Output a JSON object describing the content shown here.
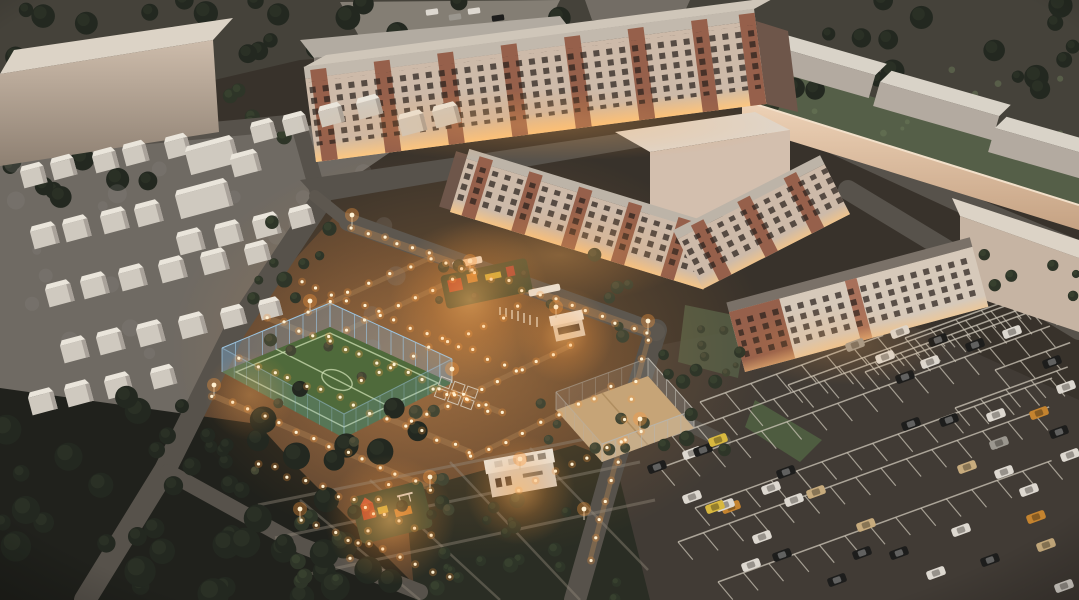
{
  "meta": {
    "type": "aerial-architectural-rendering",
    "time_of_day": "dusk"
  },
  "palette": {
    "night_ground": "#38322b",
    "top_ground": "#4a473f",
    "road": "#57524b",
    "road_edge": "#736c63",
    "asphalt_parking": "#413b35",
    "parking_line": "#cfc8ba",
    "beige_face": "#c8b6a5",
    "beige_roof": "#dcd3c6",
    "beige_shadow": "#8e7f72",
    "wall_warm": "#e2c3a8",
    "brick": "#96604b",
    "facade_base": "#cdbaa9",
    "window_dark": "#2f2722",
    "window_lit": "#ffd9a2",
    "gray_face": "#857e76",
    "gray_roof": "#b2aba1",
    "field_green": "#4f6a3b",
    "field_line": "#cfe0b4",
    "fence_blue": "#7fb2d8",
    "sand_court": "#c6a477",
    "lawn": "#555f48",
    "tree_dark": "#232820",
    "tree_dark2": "#2b3126",
    "tree_mid": "#2e3528",
    "tree_mid2": "#39412f",
    "olive": "#434633",
    "olive2": "#52503a",
    "pale_patch": "#8d8a82",
    "lawn_patch": "#6b7a58",
    "shed_body": "#cfc9bf",
    "shed_roof": "#eae5db",
    "shed_side": "#a9a29a",
    "ground_garage": "#6f6a63",
    "light_dot": "#fff3d6",
    "glow": "#ff9a3c",
    "path_warm": "#a97f52",
    "garden_path": "#938b7c",
    "car_w": "#ddd8d0",
    "car_k": "#1d1d1c",
    "car_s": "#9b978f",
    "car_t": "#c7ab7d",
    "car_o": "#c4832f",
    "car_y": "#d8b83f"
  },
  "scene": {
    "regions": [
      "forest-treeline-top",
      "warehouse-slab-left",
      "garage-shed-quarter",
      "long-apartment-building",
      "mid-rise-court-buildings",
      "l-shaped-apartment-building",
      "warehouse-compound-top-right",
      "warehouse-right",
      "lit-courtyard",
      "soccer-field",
      "sand-court",
      "playground-upper",
      "playground-lower",
      "kiosk-pavilion",
      "utility-building",
      "parking-lot",
      "forest-bottom-left",
      "garden-grid-bottom"
    ]
  },
  "garages": {
    "sheds": [
      [
        20,
        172,
        24,
        17
      ],
      [
        50,
        164,
        24,
        17
      ],
      [
        92,
        157,
        24,
        17
      ],
      [
        122,
        150,
        24,
        17
      ],
      [
        164,
        143,
        24,
        17
      ],
      [
        250,
        128,
        24,
        16
      ],
      [
        282,
        121,
        24,
        16
      ],
      [
        318,
        112,
        24,
        16
      ],
      [
        356,
        104,
        24,
        16
      ],
      [
        398,
        120,
        26,
        17
      ],
      [
        432,
        112,
        26,
        17
      ],
      [
        185,
        152,
        50,
        24
      ],
      [
        175,
        196,
        54,
        24
      ],
      [
        30,
        232,
        26,
        18
      ],
      [
        62,
        225,
        26,
        18
      ],
      [
        100,
        217,
        26,
        18
      ],
      [
        134,
        210,
        26,
        18
      ],
      [
        176,
        238,
        26,
        18
      ],
      [
        214,
        230,
        26,
        18
      ],
      [
        252,
        222,
        26,
        18
      ],
      [
        288,
        214,
        24,
        16
      ],
      [
        45,
        290,
        26,
        18
      ],
      [
        80,
        282,
        26,
        18
      ],
      [
        118,
        274,
        26,
        18
      ],
      [
        158,
        266,
        26,
        18
      ],
      [
        200,
        258,
        26,
        18
      ],
      [
        244,
        250,
        24,
        16
      ],
      [
        60,
        346,
        26,
        18
      ],
      [
        96,
        338,
        26,
        18
      ],
      [
        136,
        330,
        26,
        18
      ],
      [
        178,
        322,
        26,
        18
      ],
      [
        220,
        314,
        24,
        16
      ],
      [
        258,
        306,
        22,
        15
      ],
      [
        28,
        398,
        26,
        18
      ],
      [
        64,
        390,
        26,
        18
      ],
      [
        104,
        382,
        26,
        18
      ],
      [
        150,
        374,
        24,
        16
      ],
      [
        230,
        160,
        28,
        18
      ]
    ]
  },
  "vegetation": {
    "back_clusters": [
      {
        "x": 0,
        "y": 0,
        "w": 1079,
        "h": 92,
        "n": 55,
        "rmin": 6,
        "rmax": 13,
        "tone": "dark"
      },
      {
        "x": 0,
        "y": 80,
        "w": 150,
        "h": 120,
        "n": 14,
        "rmin": 6,
        "rmax": 12,
        "tone": "dark"
      },
      {
        "x": 695,
        "y": 55,
        "w": 100,
        "h": 80,
        "n": 10,
        "rmin": 5,
        "rmax": 10,
        "tone": "mid"
      },
      {
        "x": 230,
        "y": 85,
        "w": 80,
        "h": 65,
        "n": 6,
        "rmin": 4,
        "rmax": 8,
        "tone": "mid"
      },
      {
        "x": 0,
        "y": 155,
        "w": 430,
        "h": 250,
        "n": 26,
        "rmin": 4,
        "rmax": 10,
        "tone": "pale"
      },
      {
        "x": 738,
        "y": 62,
        "w": 341,
        "h": 100,
        "n": 16,
        "rmin": 2,
        "rmax": 4,
        "tone": "lawnpatch"
      }
    ],
    "front_clusters": [
      {
        "x": 0,
        "y": 388,
        "w": 420,
        "h": 212,
        "n": 46,
        "rmin": 8,
        "rmax": 16,
        "tone": "dark"
      },
      {
        "x": 150,
        "y": 382,
        "w": 80,
        "h": 86,
        "n": 7,
        "rmin": 5,
        "rmax": 9,
        "tone": "dark"
      },
      {
        "x": 275,
        "y": 497,
        "w": 360,
        "h": 103,
        "n": 30,
        "rmin": 4,
        "rmax": 8,
        "tone": "mid"
      },
      {
        "x": 250,
        "y": 330,
        "w": 210,
        "h": 180,
        "n": 13,
        "rmin": 4,
        "rmax": 7,
        "tone": "olive"
      },
      {
        "x": 432,
        "y": 250,
        "w": 200,
        "h": 108,
        "n": 12,
        "rmin": 4,
        "rmax": 7,
        "tone": "olive"
      },
      {
        "x": 540,
        "y": 382,
        "w": 120,
        "h": 86,
        "n": 8,
        "rmin": 4,
        "rmax": 6,
        "tone": "olive"
      },
      {
        "x": 655,
        "y": 350,
        "w": 105,
        "h": 115,
        "n": 10,
        "rmin": 5,
        "rmax": 8,
        "tone": "mid"
      },
      {
        "x": 685,
        "y": 305,
        "w": 62,
        "h": 68,
        "n": 6,
        "rmin": 3,
        "rmax": 5,
        "tone": "olive"
      },
      {
        "x": 975,
        "y": 245,
        "w": 104,
        "h": 55,
        "n": 6,
        "rmin": 4,
        "rmax": 7,
        "tone": "mid"
      },
      {
        "x": 240,
        "y": 212,
        "w": 95,
        "h": 115,
        "n": 9,
        "rmin": 4,
        "rmax": 8,
        "tone": "mid"
      }
    ]
  },
  "lighting": {
    "strings": [
      [
        352,
        228,
        648,
        332,
        20
      ],
      [
        300,
        282,
        520,
        370,
        15
      ],
      [
        268,
        318,
        500,
        412,
        16
      ],
      [
        240,
        358,
        470,
        452,
        15
      ],
      [
        214,
        396,
        430,
        488,
        14
      ],
      [
        258,
        462,
        430,
        534,
        12
      ],
      [
        300,
        520,
        450,
        576,
        10
      ],
      [
        470,
        272,
        330,
        338,
        9
      ],
      [
        520,
        308,
        360,
        382,
        10
      ],
      [
        570,
        346,
        410,
        422,
        10
      ],
      [
        612,
        388,
        470,
        458,
        9
      ],
      [
        640,
        430,
        520,
        490,
        8
      ],
      [
        430,
        258,
        310,
        312,
        7
      ],
      [
        648,
        340,
        590,
        560,
        12
      ],
      [
        388,
        486,
        352,
        560,
        6
      ],
      [
        435,
        388,
        488,
        410,
        6
      ]
    ],
    "poles": [
      [
        352,
        226
      ],
      [
        470,
        272
      ],
      [
        648,
        332
      ],
      [
        214,
        396
      ],
      [
        430,
        488
      ],
      [
        640,
        430
      ],
      [
        556,
        318
      ],
      [
        310,
        312
      ],
      [
        452,
        380
      ],
      [
        520,
        470
      ],
      [
        300,
        520
      ],
      [
        584,
        520
      ]
    ]
  },
  "vehicles": {
    "parking": [
      [
        900,
        332,
        "w"
      ],
      [
        938,
        340,
        "k"
      ],
      [
        996,
        415,
        "w"
      ],
      [
        1039,
        413,
        "o"
      ],
      [
        949,
        420,
        "k"
      ],
      [
        911,
        424,
        "k"
      ],
      [
        1059,
        432,
        "k"
      ],
      [
        999,
        443,
        "s"
      ],
      [
        786,
        472,
        "k"
      ],
      [
        771,
        488,
        "w"
      ],
      [
        816,
        492,
        "t"
      ],
      [
        794,
        500,
        "w"
      ],
      [
        731,
        507,
        "o"
      ],
      [
        866,
        525,
        "t"
      ],
      [
        967,
        467,
        "t"
      ],
      [
        1004,
        472,
        "w"
      ],
      [
        1029,
        490,
        "w"
      ],
      [
        1036,
        517,
        "o"
      ],
      [
        961,
        530,
        "w"
      ],
      [
        762,
        537,
        "w"
      ],
      [
        782,
        555,
        "k"
      ],
      [
        751,
        565,
        "w"
      ],
      [
        837,
        580,
        "k"
      ],
      [
        936,
        573,
        "w"
      ],
      [
        899,
        553,
        "k"
      ],
      [
        862,
        553,
        "k"
      ],
      [
        657,
        467,
        "k"
      ],
      [
        692,
        453,
        "w"
      ],
      [
        703,
        450,
        "k"
      ],
      [
        718,
        440,
        "y"
      ],
      [
        692,
        497,
        "w"
      ],
      [
        725,
        505,
        "w"
      ],
      [
        715,
        507,
        "y"
      ],
      [
        975,
        345,
        "k"
      ],
      [
        1012,
        332,
        "w"
      ],
      [
        1052,
        362,
        "k"
      ],
      [
        930,
        362,
        "w"
      ],
      [
        905,
        377,
        "k"
      ],
      [
        1066,
        387,
        "w"
      ],
      [
        855,
        345,
        "s"
      ],
      [
        885,
        357,
        "w"
      ],
      [
        1070,
        455,
        "w"
      ],
      [
        1046,
        545,
        "t"
      ],
      [
        990,
        560,
        "k"
      ],
      [
        1064,
        586,
        "w"
      ]
    ],
    "street": [
      [
        432,
        12,
        "w",
        -8
      ],
      [
        455,
        17,
        "s",
        -8
      ],
      [
        474,
        11,
        "w",
        -8
      ],
      [
        498,
        18,
        "k",
        -8
      ]
    ],
    "angle_default": -20
  },
  "parking_layout": {
    "rows": [
      [
        905,
        338,
        170
      ],
      [
        865,
        372,
        215
      ],
      [
        788,
        385,
        285
      ],
      [
        700,
        402,
        195
      ],
      [
        955,
        408,
        120
      ],
      [
        672,
        436,
        400
      ],
      [
        660,
        468,
        415
      ],
      [
        695,
        508,
        380
      ],
      [
        678,
        542,
        395
      ],
      [
        718,
        582,
        355
      ],
      [
        995,
        370,
        80
      ]
    ],
    "row_angle": -20,
    "divider_step": 27,
    "divider_len": 23,
    "divider_angle": 50
  },
  "fences": {
    "soccer": {
      "pts": [
        [
          222,
          372
        ],
        [
          330,
          327
        ],
        [
          452,
          383
        ],
        [
          344,
          438
        ]
      ],
      "h": 24,
      "color": "rgba(127,178,216,0.32)",
      "post": "#9cc4e0"
    },
    "sand": {
      "pts": [
        [
          648,
          376
        ],
        [
          694,
          428
        ],
        [
          602,
          462
        ],
        [
          556,
          410
        ]
      ],
      "h": 18,
      "color": "rgba(205,205,205,0.22)",
      "post": "#b9b4aa"
    }
  }
}
